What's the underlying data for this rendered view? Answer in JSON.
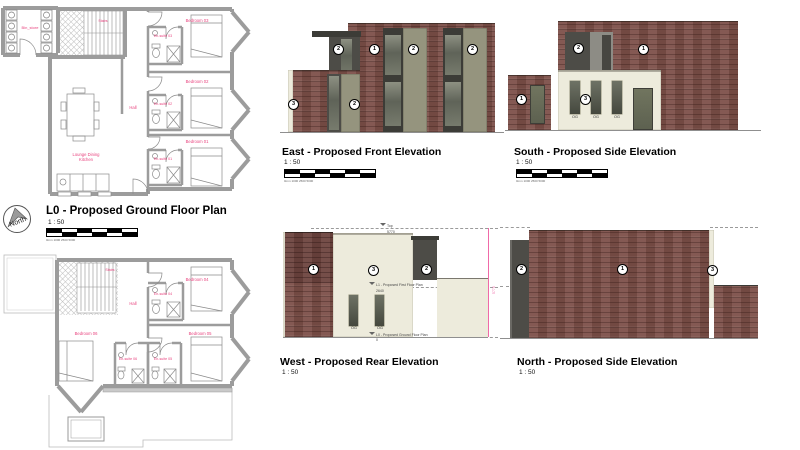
{
  "north_arrow": {
    "label": "North"
  },
  "plans": {
    "ground": {
      "title": "L0 - Proposed Ground Floor Plan",
      "scale": "1 : 50",
      "rooms": {
        "bin_store": "Bin_store",
        "stairs": "Stairs",
        "hall": "Hall",
        "lounge_line1": "Lounge Dining",
        "lounge_line2": "Kitchen",
        "bedroom_03": "Bedroom 03",
        "ensuite_03": "En-suite 03",
        "bedroom_02": "Bedroom 02",
        "ensuite_02": "En-suite 02",
        "bedroom_01": "Bedroom 01",
        "ensuite_01": "En-suite 01"
      }
    },
    "first": {
      "rooms": {
        "stairs": "Stairs",
        "hall": "Hall",
        "bedroom_04": "Bedroom 04",
        "ensuite_04": "En-suite 04",
        "bedroom_05": "Bedroom 05",
        "ensuite_05": "En-suite 05",
        "bedroom_06": "Bedroom 06",
        "ensuite_06": "En-suite 06"
      }
    }
  },
  "elevations": {
    "east": {
      "title": "East - Proposed Front Elevation",
      "scale": "1 : 50"
    },
    "south": {
      "title": "South - Proposed Side Elevation",
      "scale": "1 : 50"
    },
    "west": {
      "title": "West - Proposed Rear Elevation",
      "scale": "1 : 50"
    },
    "north": {
      "title": "North - Proposed Side Elevation",
      "scale": "1 : 50"
    }
  },
  "keynotes": {
    "brick": "1",
    "cladding": "2",
    "render": "3"
  },
  "glazing": {
    "obscure": "OG"
  },
  "levels": {
    "top": {
      "label": "Top",
      "value": "5770"
    },
    "l1": {
      "label": "L1 - Proposed First Floor Plan",
      "value": "2640"
    },
    "l0": {
      "label": "L0 - Proposed Ground Floor Plan",
      "value": "0"
    }
  },
  "scalebar_note": "0mm 1000 2500 5000",
  "colors": {
    "brick": "#7c4f48",
    "brick_dark": "#6e443f",
    "render": "#edebdc",
    "panel_dark": "#4d4c47",
    "cladding_olive": "#95947e",
    "door_olive": "#6a6e60",
    "label_pink": "#e8447f",
    "dim_pink": "#f06aa8",
    "wall_gray": "#9c9c9c"
  }
}
